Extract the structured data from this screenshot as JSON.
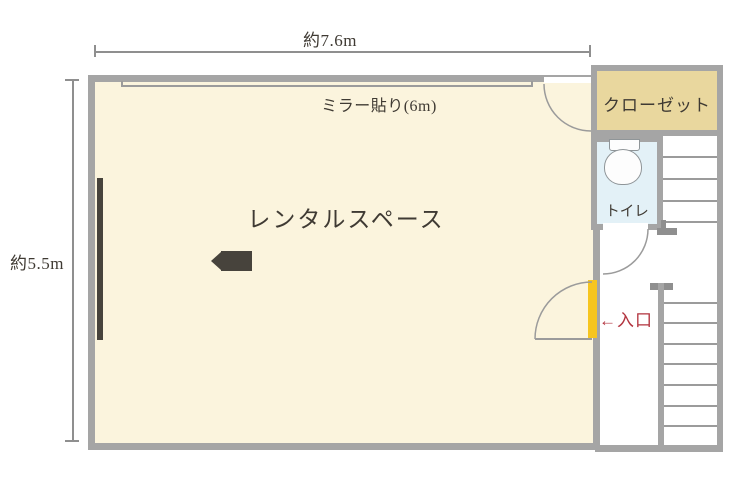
{
  "dimensions": {
    "width_label": "約7.6m",
    "height_label": "約5.5m"
  },
  "rooms": {
    "main_label": "レンタルスペース",
    "closet_label": "クローゼット",
    "toilet_label": "トイレ"
  },
  "annotations": {
    "mirror_label": "ミラー貼り(6m)",
    "entrance_label": "←入口"
  },
  "icons": {
    "camera": "video-camera-icon",
    "toilet": "toilet-icon"
  },
  "colors": {
    "wall": "#a5a5a5",
    "wall_dark": "#8f8f8f",
    "room_fill": "#fbf4dd",
    "closet_fill": "#e9d79e",
    "toilet_fill": "#e3f1f7",
    "door_yellow": "#f6c51f",
    "entrance_red": "#b2333e",
    "dark_element": "#47433c",
    "line_gray": "#9b9b9b",
    "text": "#3f3a33"
  }
}
